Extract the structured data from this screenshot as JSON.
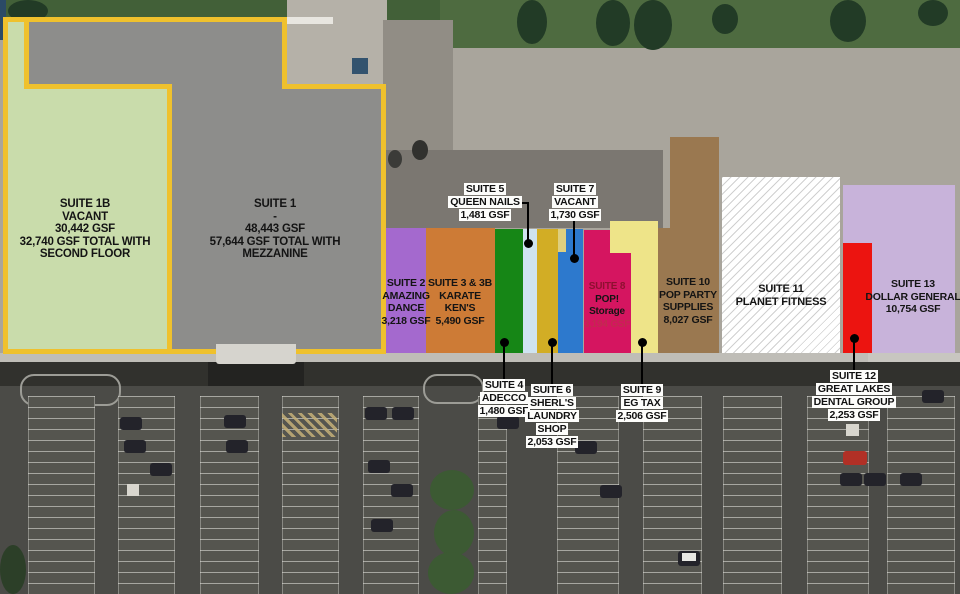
{
  "plan": {
    "outline_color": "#efc12d",
    "suites": [
      {
        "id": "1B",
        "lines": [
          "SUITE 1B",
          "VACANT",
          "30,442 GSF",
          "32,740 GSF TOTAL WITH",
          "SECOND FLOOR"
        ],
        "color": "#c9dcab"
      },
      {
        "id": "1",
        "lines": [
          "SUITE 1",
          "-",
          "48,443 GSF",
          "57,644 GSF TOTAL WITH",
          "MEZZANINE"
        ],
        "color": "#8d8d8b"
      },
      {
        "id": "2",
        "lines": [
          "SUITE 2",
          "AMAZING",
          "DANCE",
          "3,218 GSF"
        ],
        "color": "#a469ce"
      },
      {
        "id": "3",
        "lines": [
          "SUITE 3 & 3B",
          "KARATE",
          "KEN'S",
          "5,490 GSF"
        ],
        "color": "#cd7b36"
      },
      {
        "id": "4",
        "lines": [
          "SUITE 4",
          "ADECCO",
          "1,480 GSF"
        ],
        "color": "#168616"
      },
      {
        "id": "5",
        "lines": [
          "SUITE 5",
          "QUEEN NAILS",
          "1,481 GSF"
        ],
        "color": "#cfe3f1"
      },
      {
        "id": "6",
        "lines": [
          "SUITE 6",
          "SHERL'S",
          "LAUNDRY",
          "SHOP",
          "2,053 GSF"
        ],
        "color": "#d2ad25"
      },
      {
        "id": "7",
        "lines": [
          "SUITE 7",
          "VACANT",
          "1,730 GSF"
        ],
        "color": "#2d79cd"
      },
      {
        "id": "8",
        "lines": [
          "SUITE 8",
          "POP!",
          "Storage",
          "3,194 GSF"
        ],
        "color": "#d51560"
      },
      {
        "id": "9",
        "lines": [
          "SUITE 9",
          "EG TAX",
          "2,506 GSF"
        ],
        "color": "#eee489"
      },
      {
        "id": "10",
        "lines": [
          "SUITE 10",
          "POP PARTY",
          "SUPPLIES",
          "8,027 GSF"
        ],
        "color": "#9a7850"
      },
      {
        "id": "11",
        "lines": [
          "SUITE 11",
          "PLANET FITNESS"
        ],
        "color": "#ffffff"
      },
      {
        "id": "12",
        "lines": [
          "SUITE 12",
          "GREAT LAKES",
          "DENTAL GROUP",
          "2,253 GSF"
        ],
        "color": "#ec1410"
      },
      {
        "id": "13",
        "lines": [
          "SUITE 13",
          "DOLLAR GENERAL",
          "10,754 GSF"
        ],
        "color": "#c8b3da"
      }
    ]
  }
}
